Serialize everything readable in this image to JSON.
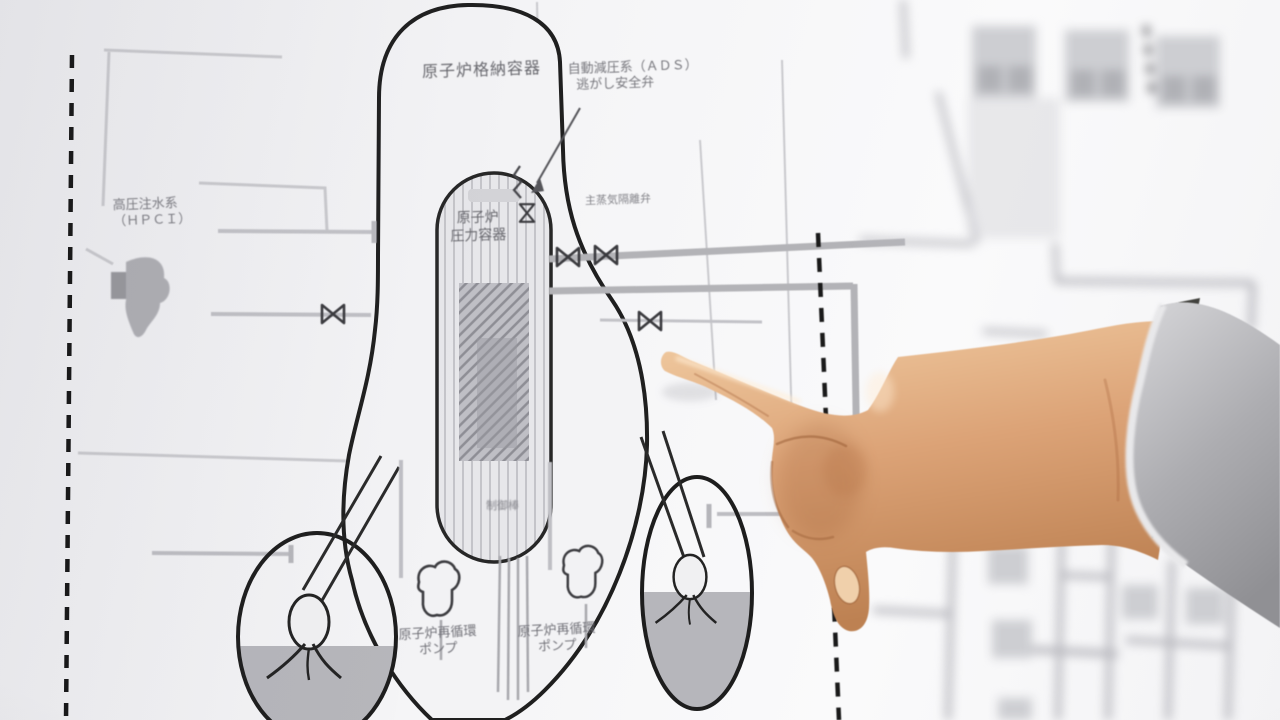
{
  "diagram": {
    "labels": {
      "containment": "原子炉格納容器",
      "ads_line1": "自動減圧系（ＡＤＳ）",
      "ads_line2": "逃がし安全弁",
      "msiv": "主蒸気隔離弁",
      "rpv_line1": "原子炉",
      "rpv_line2": "圧力容器",
      "hpci_line1": "高圧注水系",
      "hpci_line2": "（ＨＰＣＩ）",
      "control_rods": "制御棒",
      "recirc_left_line1": "原子炉再循環",
      "recirc_left_line2": "ポンプ",
      "recirc_right_line1": "原子炉再循環",
      "recirc_right_line2": "ポンプ"
    },
    "colors": {
      "chart_line_black": "#1f1f1f",
      "pipe_gray": "#b3b3b7",
      "grid_gray": "#c9c9cd",
      "water_gray": "#b6b6bb",
      "label_gray": "#6b6b71",
      "paper_white": "#f4f4f6",
      "skin_light": "#eec69c",
      "skin_mid": "#d9a272",
      "skin_dark": "#bd8152",
      "sleeve_gray": "#a7a7ab",
      "cuff_white": "#e8e8ea",
      "watch_dark": "#3b403b"
    }
  }
}
